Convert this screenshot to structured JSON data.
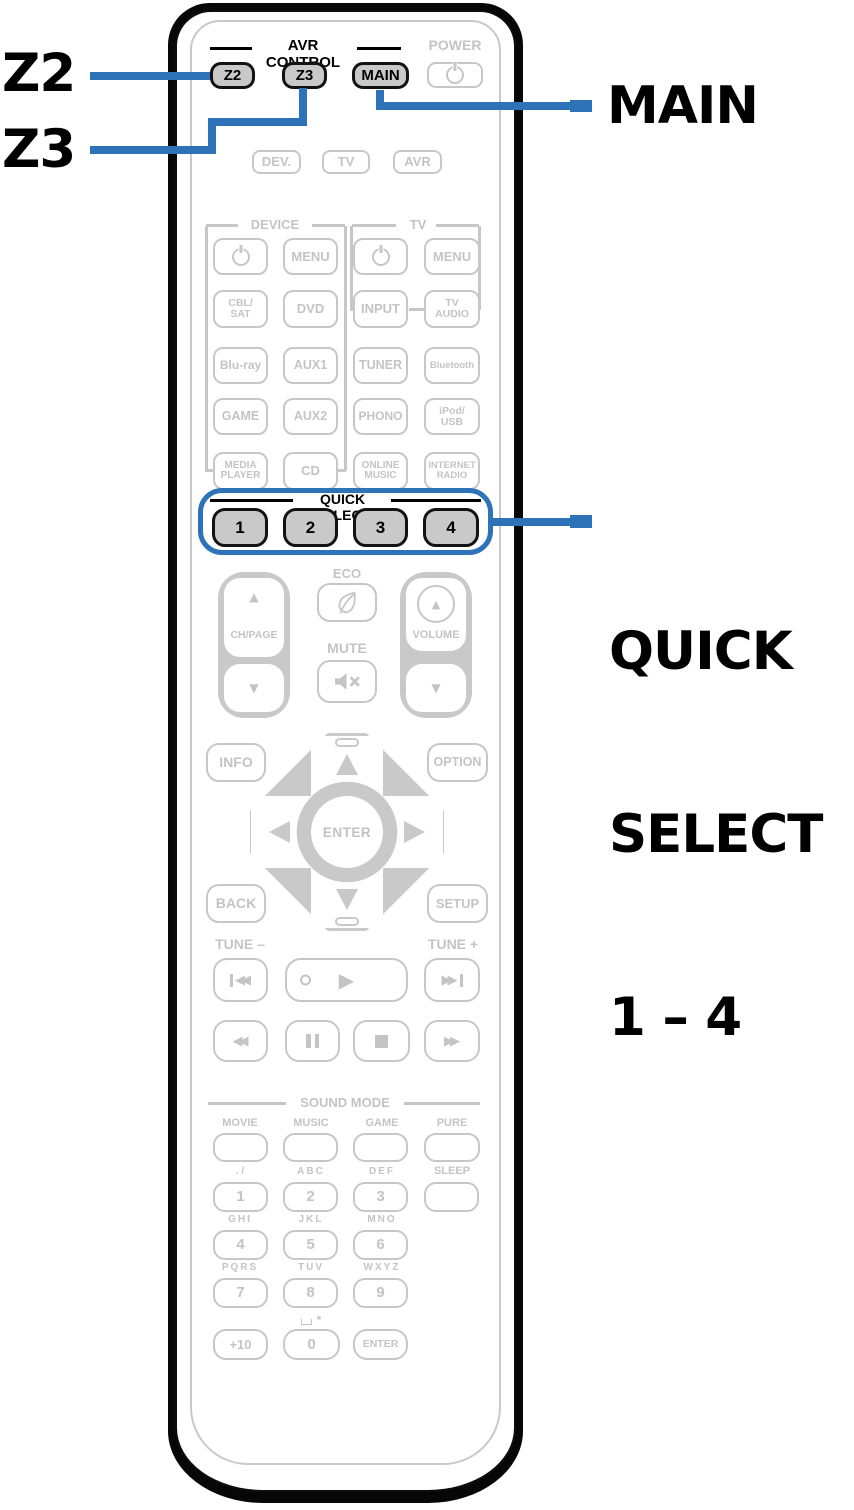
{
  "accent_blue": "#2e72b8",
  "gray": "#c7c7c7",
  "callouts": {
    "z2": "Z2",
    "z3": "Z3",
    "main": "MAIN",
    "qs1": "QUICK",
    "qs2": "SELECT",
    "qs3": "1 – 4"
  },
  "header": {
    "avr_control": "AVR CONTROL",
    "power": "POWER"
  },
  "avr": {
    "z2": "Z2",
    "z3": "Z3",
    "main": "MAIN"
  },
  "modes": [
    "DEV.",
    "TV",
    "AVR"
  ],
  "device_tv": {
    "device_header": "DEVICE",
    "tv_header": "TV",
    "r1": [
      "MENU",
      "MENU"
    ],
    "r2": [
      "CBL/\nSAT",
      "DVD",
      "INPUT",
      "TV\nAUDIO"
    ],
    "r3": [
      "Blu-ray",
      "AUX1",
      "TUNER",
      "Bluetooth"
    ],
    "r4": [
      "GAME",
      "AUX2",
      "PHONO",
      "iPod/\nUSB"
    ],
    "r5": [
      "MEDIA\nPLAYER",
      "CD",
      "ONLINE\nMUSIC",
      "INTERNET\nRADIO"
    ]
  },
  "quick_select": {
    "header": "QUICK SELECT",
    "b": [
      "1",
      "2",
      "3",
      "4"
    ]
  },
  "mid": {
    "eco": "ECO",
    "ch_page": "CH/PAGE",
    "mute": "MUTE",
    "volume": "VOLUME"
  },
  "nav": {
    "info": "INFO",
    "option": "OPTION",
    "enter": "ENTER",
    "back": "BACK",
    "setup": "SETUP",
    "tune_minus": "TUNE –",
    "tune_plus": "TUNE +"
  },
  "sound_mode": {
    "header": "SOUND MODE",
    "labels": [
      "MOVIE",
      "MUSIC",
      "GAME",
      "PURE"
    ]
  },
  "keypad": {
    "l": [
      ". /",
      "ABC",
      "DEF",
      "GHI",
      "JKL",
      "MNO",
      "PQRS",
      "TUV",
      "WXYZ"
    ],
    "sleep": "SLEEP",
    "d": [
      "1",
      "2",
      "3",
      "4",
      "5",
      "6",
      "7",
      "8",
      "9"
    ],
    "plus10": "+10",
    "zero": "0",
    "enter": "ENTER",
    "star": "*"
  },
  "icons": {
    "up": "▲",
    "down": "▼",
    "play": "▶",
    "rewind": "◀◀",
    "fast_forward": "▶▶"
  }
}
